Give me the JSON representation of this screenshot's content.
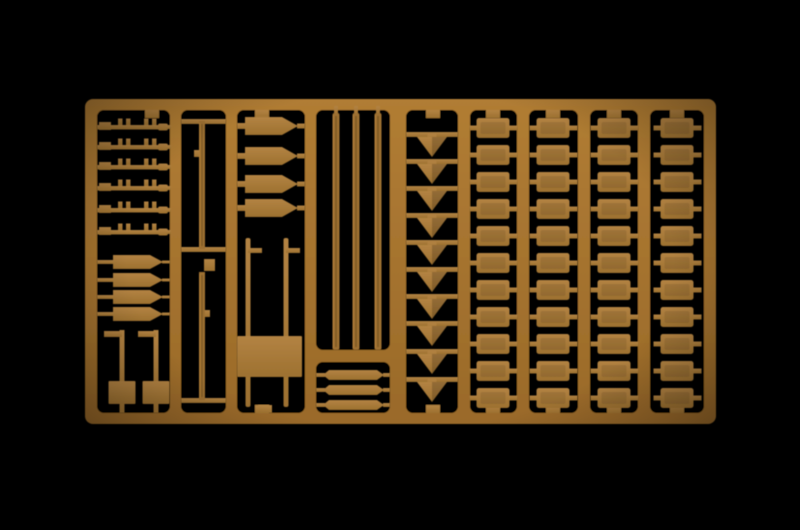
{
  "scene": {
    "type": "photograph",
    "subject": "tan plastic model-kit parts sprue on black background",
    "background_color": "#000000",
    "palette": {
      "frame_light": "#b17d34",
      "frame_dark": "#9a6a2a",
      "part_light": "#b38343",
      "part_dark": "#9d7130",
      "wood_base": "#9d7030",
      "wood_streak": "#6e4e1f",
      "wood_highlight": "#b5813a",
      "shade": "rgba(0,0,0,0.18)",
      "background": "#000000"
    }
  },
  "sprue": {
    "frame": {
      "x": 85,
      "y": 99,
      "width": 631,
      "height": 325,
      "corner_radius": 8
    },
    "compartments": [
      [
        97,
        110,
        73,
        303
      ],
      [
        181,
        110,
        45,
        303
      ],
      [
        237,
        110,
        68,
        303
      ],
      [
        316,
        110,
        74,
        240
      ],
      [
        316,
        362,
        74,
        51
      ],
      [
        406,
        110,
        52,
        303
      ],
      [
        470,
        110,
        47,
        303
      ],
      [
        529,
        110,
        49,
        303
      ],
      [
        590,
        110,
        48,
        303
      ],
      [
        650,
        110,
        54,
        303
      ]
    ],
    "top_tabs_x": [
      152,
      262,
      433,
      493,
      553,
      614,
      677
    ],
    "bottom_tabs_x": [
      262,
      433,
      493,
      553,
      614,
      677
    ],
    "sections": {
      "rifle_tools": {
        "count": 6,
        "row_centers_y": [
          127,
          147,
          167,
          188,
          210,
          232
        ],
        "bar_x": 97,
        "bar_len": 66,
        "nub_offsets_x": [
          118,
          126,
          144,
          152
        ]
      },
      "shovels": {
        "count": 4,
        "row_centers_y": [
          262,
          280,
          297,
          314
        ]
      },
      "sign_posts": {
        "count": 2,
        "x_centers": [
          122,
          156
        ],
        "post_top_y": 330,
        "post_bottom_y": 413,
        "plate": {
          "y": 381,
          "w": 27,
          "h": 23
        }
      },
      "short_poles": {
        "count": 2,
        "x_center": 202,
        "rod_w": 6,
        "spans_y": [
          [
            121,
            249
          ],
          [
            272,
            400
          ]
        ],
        "crossbars_y": [
          119,
          247,
          398
        ],
        "square_part": [
          204,
          259,
          11,
          12
        ]
      },
      "blades": {
        "count": 4,
        "row_centers_y": [
          126,
          156,
          184,
          208
        ]
      },
      "table": {
        "legs_x": [
          248,
          286
        ],
        "legs_top_y": 238,
        "legs_bottom_y": 407,
        "top_rect": [
          237,
          336,
          65,
          41
        ],
        "bottom_tab": [
          258,
          405,
          14,
          8
        ]
      },
      "long_poles": {
        "count": 3,
        "x_centers": [
          336,
          356,
          378
        ],
        "y_top": 113,
        "y_bottom": 350,
        "rod_w": 7
      },
      "paddles": {
        "count": 3,
        "row_centers_y": [
          375,
          390,
          405
        ]
      },
      "arrow_stakes": {
        "count": 10,
        "x_center": 432,
        "tri_half_w": 15,
        "tri_h": 20,
        "row_tops_y": [
          132,
          159,
          186,
          213,
          240,
          267,
          294,
          321,
          349,
          377
        ],
        "runner_x": 406,
        "runner_w": 52
      },
      "box_columns": {
        "columns_x_center": [
          493,
          553,
          614,
          677
        ],
        "row_centers_y": [
          128,
          155,
          182,
          209,
          236,
          263,
          290,
          317,
          344,
          371,
          398
        ],
        "rect_w": 33,
        "rect_h": 20
      }
    }
  }
}
